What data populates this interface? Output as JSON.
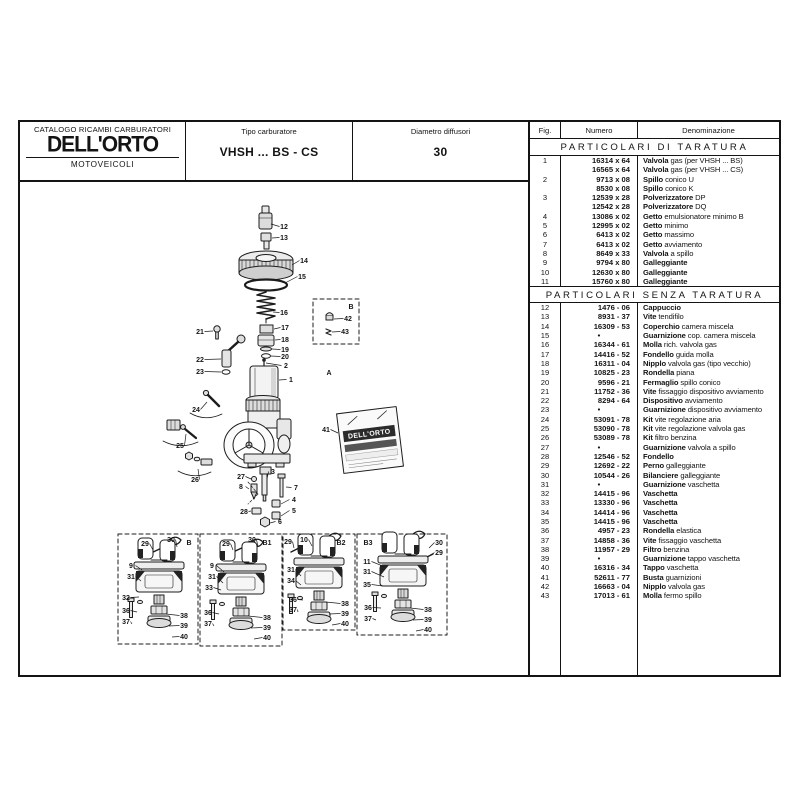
{
  "header": {
    "catalog_title": "CATALOGO RICAMBI CARBURATORI",
    "brand": "DELL'ORTO",
    "division": "MOTOVEICOLI",
    "tipo_label": "Tipo carburatore",
    "tipo_value": "VHSH ... BS - CS",
    "diametro_label": "Diametro diffusori",
    "diametro_value": "30"
  },
  "table": {
    "columns": [
      "Fig.",
      "Numero",
      "Denominazione"
    ],
    "sections": [
      {
        "title": "PARTICOLARI DI TARATURA",
        "rows": [
          [
            "1",
            "16314 x 64",
            "Valvola",
            "gas (per VHSH ... BS)"
          ],
          [
            "",
            "16565 x 64",
            "Valvola",
            "gas (per VHSH ... CS)"
          ],
          [
            "2",
            "9713 x 08",
            "Spillo",
            "conico U"
          ],
          [
            "",
            "8530 x 08",
            "Spillo",
            "conico K"
          ],
          [
            "3",
            "12539 x 28",
            "Polverizzatore",
            "DP"
          ],
          [
            "",
            "12542 x 28",
            "Polverizzatore",
            "DQ"
          ],
          [
            "4",
            "13086 x 02",
            "Getto",
            "emulsionatore minimo B"
          ],
          [
            "5",
            "12995 x 02",
            "Getto",
            "minimo"
          ],
          [
            "6",
            "6413 x 02",
            "Getto",
            "massimo"
          ],
          [
            "7",
            "6413 x 02",
            "Getto",
            "avviamento"
          ],
          [
            "8",
            "8649 x 33",
            "Valvola",
            "a spillo"
          ],
          [
            "9",
            "9794 x 80",
            "Galleggiante",
            ""
          ],
          [
            "10",
            "12630 x 80",
            "Galleggiante",
            ""
          ],
          [
            "11",
            "15760 x 80",
            "Galleggiante",
            ""
          ]
        ]
      },
      {
        "title": "PARTICOLARI SENZA TARATURA",
        "rows": [
          [
            "12",
            "1476 - 06",
            "Cappuccio",
            ""
          ],
          [
            "13",
            "8931 - 37",
            "Vite",
            "tendifilo"
          ],
          [
            "14",
            "16309 - 53",
            "Coperchio",
            "camera miscela"
          ],
          [
            "15",
            "•",
            "Guarnizione",
            "cop. camera miscela"
          ],
          [
            "16",
            "16344 - 61",
            "Molla",
            "rich. valvola gas"
          ],
          [
            "17",
            "14416 - 52",
            "Fondello",
            "guida molla"
          ],
          [
            "18",
            "16311 - 04",
            "Nipplo",
            "valvola gas (tipo vecchio)"
          ],
          [
            "19",
            "10825 - 23",
            "Rondella",
            "piana"
          ],
          [
            "20",
            "9596 - 21",
            "Fermaglio",
            "spillo conico"
          ],
          [
            "21",
            "11752 - 36",
            "Vite",
            "fissaggio dispositivo avviamento"
          ],
          [
            "22",
            "8294 - 64",
            "Dispositivo",
            "avviamento"
          ],
          [
            "23",
            "•",
            "Guarnizione",
            "dispositivo avviamento"
          ],
          [
            "24",
            "53091 - 78",
            "Kit",
            "vite regolazione aria"
          ],
          [
            "25",
            "53090 - 78",
            "Kit",
            "vite regolazione valvola gas"
          ],
          [
            "26",
            "53089 - 78",
            "Kit",
            "filtro benzina"
          ],
          [
            "27",
            "•",
            "Guarnizione",
            "valvola a spillo"
          ],
          [
            "28",
            "12546 - 52",
            "Fondello",
            ""
          ],
          [
            "29",
            "12692 - 22",
            "Perno",
            "galleggiante"
          ],
          [
            "30",
            "10544 - 26",
            "Bilanciere",
            "galleggiante"
          ],
          [
            "31",
            "•",
            "Guarnizione",
            "vaschetta"
          ],
          [
            "32",
            "14415 - 96",
            "Vaschetta",
            ""
          ],
          [
            "33",
            "13330 - 96",
            "Vaschetta",
            ""
          ],
          [
            "34",
            "14414 - 96",
            "Vaschetta",
            ""
          ],
          [
            "35",
            "14415 - 96",
            "Vaschetta",
            ""
          ],
          [
            "36",
            "4957 - 23",
            "Rondella",
            "elastica"
          ],
          [
            "37",
            "14858 - 36",
            "Vite",
            "fissaggio vaschetta"
          ],
          [
            "38",
            "11957 - 29",
            "Filtro",
            "benzina"
          ],
          [
            "39",
            "•",
            "Guarnizione",
            "tappo vaschetta"
          ],
          [
            "40",
            "16316 - 34",
            "Tappo",
            "vaschetta"
          ],
          [
            "41",
            "52611 - 77",
            "Busta",
            "guarnizioni"
          ],
          [
            "42",
            "16663 - 04",
            "Nipplo",
            "valvola gas"
          ],
          [
            "43",
            "17013 - 61",
            "Molla",
            "fermo spillo"
          ]
        ]
      }
    ]
  },
  "diagram": {
    "packet_brand": "DELL'ORTO",
    "letters": [
      {
        "t": "B",
        "x": 331,
        "y": 127,
        "size": 11
      },
      {
        "t": "A",
        "x": 309,
        "y": 193,
        "size": 17
      },
      {
        "t": "B",
        "x": 169,
        "y": 363,
        "size": 11
      },
      {
        "t": "B1",
        "x": 247,
        "y": 363,
        "size": 11
      },
      {
        "t": "B2",
        "x": 321,
        "y": 363,
        "size": 11
      },
      {
        "t": "B3",
        "x": 348,
        "y": 363,
        "size": 11
      }
    ],
    "callouts": [
      {
        "t": "12",
        "x": 264,
        "y": 47,
        "lx": 251,
        "ly": 42
      },
      {
        "t": "13",
        "x": 264,
        "y": 58,
        "lx": 252,
        "ly": 56
      },
      {
        "t": "14",
        "x": 284,
        "y": 81,
        "lx": 272,
        "ly": 83
      },
      {
        "t": "15",
        "x": 282,
        "y": 97,
        "lx": 265,
        "ly": 101
      },
      {
        "t": "16",
        "x": 264,
        "y": 133,
        "lx": 253,
        "ly": 130
      },
      {
        "t": "17",
        "x": 265,
        "y": 148,
        "lx": 254,
        "ly": 147
      },
      {
        "t": "18",
        "x": 265,
        "y": 160,
        "lx": 255,
        "ly": 158
      },
      {
        "t": "19",
        "x": 265,
        "y": 170,
        "lx": 252,
        "ly": 167
      },
      {
        "t": "20",
        "x": 265,
        "y": 177,
        "lx": 251,
        "ly": 174
      },
      {
        "t": "2",
        "x": 266,
        "y": 186,
        "lx": 246,
        "ly": 181
      },
      {
        "t": "1",
        "x": 271,
        "y": 200,
        "lx": 259,
        "ly": 198
      },
      {
        "t": "21",
        "x": 180,
        "y": 152,
        "lx": 193,
        "ly": 149
      },
      {
        "t": "22",
        "x": 180,
        "y": 180,
        "lx": 201,
        "ly": 177
      },
      {
        "t": "23",
        "x": 180,
        "y": 192,
        "lx": 201,
        "ly": 190
      },
      {
        "t": "24",
        "x": 176,
        "y": 230,
        "lx": 187,
        "ly": 220
      },
      {
        "t": "25",
        "x": 160,
        "y": 266,
        "lx": 166,
        "ly": 252
      },
      {
        "t": "26",
        "x": 175,
        "y": 300,
        "lx": 178,
        "ly": 287
      },
      {
        "t": "27",
        "x": 221,
        "y": 297,
        "lx": 231,
        "ly": 297
      },
      {
        "t": "8",
        "x": 221,
        "y": 307,
        "lx": 229,
        "ly": 307
      },
      {
        "t": "3",
        "x": 253,
        "y": 292,
        "lx": 247,
        "ly": 297
      },
      {
        "t": "7",
        "x": 276,
        "y": 308,
        "lx": 266,
        "ly": 305
      },
      {
        "t": "4",
        "x": 274,
        "y": 320,
        "lx": 261,
        "ly": 322
      },
      {
        "t": "5",
        "x": 274,
        "y": 331,
        "lx": 261,
        "ly": 334
      },
      {
        "t": "6",
        "x": 260,
        "y": 342,
        "lx": 250,
        "ly": 341
      },
      {
        "t": "28",
        "x": 224,
        "y": 332,
        "lx": 231,
        "ly": 329
      },
      {
        "t": "41",
        "x": 306,
        "y": 250,
        "lx": 318,
        "ly": 251
      },
      {
        "t": "42",
        "x": 328,
        "y": 139,
        "lx": 314,
        "ly": 137
      },
      {
        "t": "43",
        "x": 325,
        "y": 152,
        "lx": 312,
        "ly": 150
      },
      {
        "t": "29",
        "x": 125,
        "y": 364,
        "lx": 133,
        "ly": 368
      },
      {
        "t": "30",
        "x": 151,
        "y": 360,
        "lx": 157,
        "ly": 365
      },
      {
        "t": "9",
        "x": 111,
        "y": 386,
        "lx": 122,
        "ly": 388
      },
      {
        "t": "31",
        "x": 111,
        "y": 397,
        "lx": 121,
        "ly": 399
      },
      {
        "t": "32",
        "x": 106,
        "y": 418,
        "lx": 119,
        "ly": 415
      },
      {
        "t": "36",
        "x": 106,
        "y": 431,
        "lx": 117,
        "ly": 430
      },
      {
        "t": "37",
        "x": 106,
        "y": 442,
        "lx": 112,
        "ly": 442
      },
      {
        "t": "38",
        "x": 164,
        "y": 436,
        "lx": 146,
        "ly": 432
      },
      {
        "t": "39",
        "x": 164,
        "y": 446,
        "lx": 149,
        "ly": 444
      },
      {
        "t": "40",
        "x": 164,
        "y": 457,
        "lx": 152,
        "ly": 455
      },
      {
        "t": "29",
        "x": 206,
        "y": 364,
        "lx": 213,
        "ly": 368
      },
      {
        "t": "30",
        "x": 232,
        "y": 360,
        "lx": 238,
        "ly": 365
      },
      {
        "t": "9",
        "x": 192,
        "y": 386,
        "lx": 204,
        "ly": 390
      },
      {
        "t": "31",
        "x": 192,
        "y": 397,
        "lx": 203,
        "ly": 401
      },
      {
        "t": "33",
        "x": 189,
        "y": 408,
        "lx": 201,
        "ly": 408
      },
      {
        "t": "36",
        "x": 188,
        "y": 433,
        "lx": 199,
        "ly": 432
      },
      {
        "t": "37",
        "x": 188,
        "y": 444,
        "lx": 194,
        "ly": 444
      },
      {
        "t": "38",
        "x": 247,
        "y": 438,
        "lx": 228,
        "ly": 434
      },
      {
        "t": "39",
        "x": 247,
        "y": 448,
        "lx": 231,
        "ly": 446
      },
      {
        "t": "40",
        "x": 247,
        "y": 458,
        "lx": 234,
        "ly": 457
      },
      {
        "t": "29",
        "x": 268,
        "y": 362,
        "lx": 274,
        "ly": 366
      },
      {
        "t": "10",
        "x": 284,
        "y": 360,
        "lx": 292,
        "ly": 364
      },
      {
        "t": "31",
        "x": 271,
        "y": 390,
        "lx": 281,
        "ly": 394
      },
      {
        "t": "34",
        "x": 271,
        "y": 401,
        "lx": 281,
        "ly": 403
      },
      {
        "t": "36",
        "x": 273,
        "y": 420,
        "lx": 283,
        "ly": 418
      },
      {
        "t": "37",
        "x": 273,
        "y": 430,
        "lx": 278,
        "ly": 430
      },
      {
        "t": "38",
        "x": 325,
        "y": 424,
        "lx": 306,
        "ly": 420
      },
      {
        "t": "39",
        "x": 325,
        "y": 434,
        "lx": 309,
        "ly": 432
      },
      {
        "t": "40",
        "x": 325,
        "y": 444,
        "lx": 312,
        "ly": 443
      },
      {
        "t": "30",
        "x": 419,
        "y": 363,
        "lx": 409,
        "ly": 366
      },
      {
        "t": "29",
        "x": 419,
        "y": 373,
        "lx": 407,
        "ly": 375
      },
      {
        "t": "11",
        "x": 347,
        "y": 382,
        "lx": 365,
        "ly": 385
      },
      {
        "t": "31",
        "x": 347,
        "y": 392,
        "lx": 364,
        "ly": 395
      },
      {
        "t": "35",
        "x": 347,
        "y": 405,
        "lx": 363,
        "ly": 404
      },
      {
        "t": "36",
        "x": 348,
        "y": 428,
        "lx": 361,
        "ly": 426
      },
      {
        "t": "37",
        "x": 348,
        "y": 439,
        "lx": 356,
        "ly": 438
      },
      {
        "t": "38",
        "x": 408,
        "y": 430,
        "lx": 390,
        "ly": 426
      },
      {
        "t": "39",
        "x": 408,
        "y": 440,
        "lx": 393,
        "ly": 438
      },
      {
        "t": "40",
        "x": 408,
        "y": 450,
        "lx": 396,
        "ly": 449
      }
    ]
  },
  "colors": {
    "ink": "#141414",
    "paper": "#ffffff",
    "metal": "#e6e6e6"
  }
}
